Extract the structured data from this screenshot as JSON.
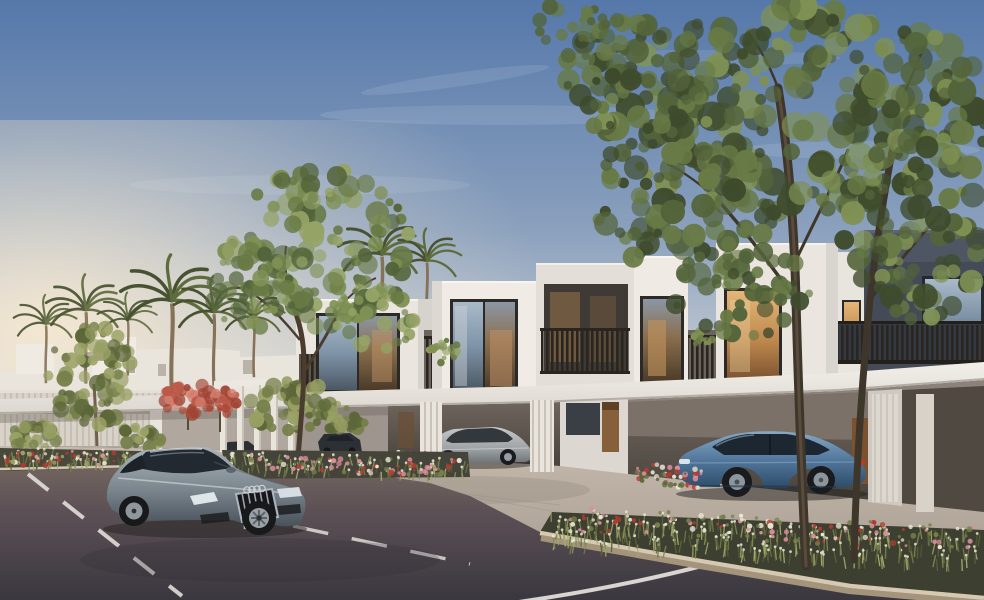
{
  "meta": {
    "description": "Architectural rendering of a modern townhouse community at dusk: white cubic two-storey townhouses with carports, a grey coupe driving on the road, a silver sedan and a blue fastback parked under carports, palm trees, large green trees and flower planters.",
    "width": 984,
    "height": 600,
    "visible_text": ""
  },
  "palette": {
    "skyTop": "#5578aa",
    "skyMid": "#8aa0bd",
    "skyLow": "#c6cdd4",
    "skyWarm": "#efe7dd",
    "glow": "#f7e9d2",
    "cloud": "#ffffff",
    "white1": "#f0ece5",
    "white2": "#e2ded8",
    "white3": "#d3cfc9",
    "parapet": "#c1bcb5",
    "darkFac": "#4e5663",
    "darkFac2": "#3c434f",
    "frame": "#2c2a28",
    "glassTop": "#a9bac9",
    "glassMid": "#7f94a8",
    "glassBot": "#4c5864",
    "warmHi": "#e4b678",
    "warm": "#c08a4e",
    "warmLo": "#7d5430",
    "rail": "#2b251f",
    "railBase": "#5d554a",
    "railBaseDark": "#343a44",
    "fascia1": "#f2efe9",
    "fascia2": "#dcd7d0",
    "soffit": "#6e675e",
    "wall1": "#b2a9a0",
    "wall2": "#9a928a",
    "wall3": "#867e76",
    "open1": "#6e655d",
    "open2": "#49433d",
    "door": "#86603a",
    "doorDark": "#5f4226",
    "fence1": "#d8d2c8",
    "fence2": "#c6bfb4",
    "pillar1": "#e9e4dc",
    "pillar2": "#c9c2b8",
    "pave1": "#c4b9ac",
    "pave2": "#a89d91",
    "pave3": "#93897e",
    "road1": "#746760",
    "road2": "#5d5156",
    "road3": "#3a373f",
    "mark": "#eae6e0",
    "curb1": "#d6c9b1",
    "curb2": "#a3947b",
    "soil": "#49483a",
    "soilDark": "#36362c",
    "grassGreen": "#7c8850",
    "grassLight": "#a3ab6e",
    "leafDark": "#3e4b2c",
    "leaf": "#53643a",
    "leafMid": "#687a45",
    "leafLight": "#7f9154",
    "leafPale": "#95a366",
    "bushDark": "#5c6638",
    "bush": "#76804a",
    "bushLight": "#98a064",
    "redTreeD": "#a04334",
    "redTree": "#bc5847",
    "redTreeL": "#d47b6b",
    "flowerWhite": "#ece7d6",
    "flowerPink": "#dc8f9c",
    "flowerRed": "#b23b33",
    "trunk": "#4a3c2e",
    "trunkLight": "#71604b",
    "palmGreen": "#5e6b3c",
    "palmDark": "#475230",
    "palmTrunk": "#857258",
    "carbody1": "#aab4ba",
    "carbody2": "#79848c",
    "carbody3": "#49525a",
    "carGlass": "#222930",
    "carChrome": "#c2c9cf",
    "blue1": "#86a9c4",
    "blue2": "#53789d",
    "blue3": "#2d4c67",
    "silver1": "#c6c7c8",
    "silver2": "#9fa3a6",
    "silver3": "#6e7377",
    "tyre": "#191b1e",
    "rim": "#969da3",
    "shadow": "#23211f",
    "plate": "#e2e2de",
    "taillight": "#c0392b"
  },
  "vehicles": [
    {
      "name": "grey-coupe-driving",
      "color": "#79848c",
      "position": "foreground road, facing right"
    },
    {
      "name": "silver-sedan-parked",
      "color": "#c6c7c8",
      "position": "middle carport"
    },
    {
      "name": "blue-fastback-parked",
      "color": "#53789d",
      "position": "right carport"
    },
    {
      "name": "distant-dark-car",
      "color": "#2c3034",
      "position": "far left driveway"
    }
  ],
  "vegetation": [
    {
      "target": "tree-right-foliage",
      "type": "leaves",
      "cx": 800,
      "cy": 108,
      "rx": 200,
      "ry": 105,
      "count": 250,
      "rmin": 5,
      "rmax": 15,
      "colors": [
        "leafDark",
        "leaf",
        "leafMid",
        "leafLight"
      ],
      "seed": 7
    },
    {
      "target": "tree-right-foliage",
      "type": "leaves",
      "cx": 688,
      "cy": 198,
      "rx": 95,
      "ry": 78,
      "count": 95,
      "rmin": 4,
      "rmax": 13,
      "colors": [
        "leafDark",
        "leaf",
        "leafMid"
      ],
      "seed": 21
    },
    {
      "target": "tree-right-foliage",
      "type": "leaves",
      "cx": 915,
      "cy": 225,
      "rx": 72,
      "ry": 95,
      "count": 90,
      "rmin": 4,
      "rmax": 13,
      "colors": [
        "leafDark",
        "leaf",
        "leafMid",
        "leafLight"
      ],
      "seed": 33
    },
    {
      "target": "tree-right-foliage",
      "type": "leaves",
      "cx": 742,
      "cy": 292,
      "rx": 70,
      "ry": 46,
      "count": 46,
      "rmin": 3,
      "rmax": 10,
      "colors": [
        "leaf",
        "leafMid",
        "leafDark"
      ],
      "seed": 44
    },
    {
      "target": "tree-right-foliage",
      "type": "leaves",
      "cx": 636,
      "cy": 76,
      "rx": 72,
      "ry": 62,
      "count": 60,
      "rmin": 4,
      "rmax": 12,
      "colors": [
        "leafDark",
        "leaf",
        "leafMid"
      ],
      "seed": 55
    },
    {
      "target": "tree-right-foliage",
      "type": "leaves",
      "cx": 596,
      "cy": 26,
      "rx": 58,
      "ry": 34,
      "count": 30,
      "rmin": 3,
      "rmax": 9,
      "colors": [
        "leaf",
        "leafMid"
      ],
      "seed": 66
    },
    {
      "target": "veg-mid-tree",
      "type": "leaves",
      "cx": 318,
      "cy": 248,
      "rx": 96,
      "ry": 80,
      "count": 130,
      "rmin": 4,
      "rmax": 12,
      "colors": [
        "leaf",
        "leafMid",
        "leafLight",
        "leafPale"
      ],
      "seed": 9
    },
    {
      "target": "veg-mid-tree",
      "type": "leaves",
      "cx": 252,
      "cy": 292,
      "rx": 46,
      "ry": 40,
      "count": 40,
      "rmin": 3,
      "rmax": 9,
      "colors": [
        "leafMid",
        "leafLight",
        "leaf"
      ],
      "seed": 19
    },
    {
      "target": "veg-mid-tree",
      "type": "leaves",
      "cx": 372,
      "cy": 318,
      "rx": 44,
      "ry": 34,
      "count": 34,
      "rmin": 3,
      "rmax": 8,
      "colors": [
        "leafMid",
        "leafLight",
        "leafPale"
      ],
      "seed": 29
    },
    {
      "target": "veg-left-tree",
      "type": "leaves",
      "cx": 92,
      "cy": 376,
      "rx": 44,
      "ry": 50,
      "count": 76,
      "rmin": 3,
      "rmax": 9,
      "colors": [
        "bushDark",
        "bush",
        "bushLight"
      ],
      "seed": 13
    },
    {
      "target": "veg-left-bushes",
      "type": "leaves",
      "cx": 32,
      "cy": 436,
      "rx": 28,
      "ry": 13,
      "count": 30,
      "rmin": 3,
      "rmax": 7,
      "colors": [
        "bushDark",
        "bush",
        "bushLight"
      ],
      "seed": 14
    },
    {
      "target": "veg-left-bushes",
      "type": "leaves",
      "cx": 142,
      "cy": 436,
      "rx": 25,
      "ry": 12,
      "count": 26,
      "rmin": 3,
      "rmax": 7,
      "colors": [
        "bushDark",
        "bush",
        "bushLight"
      ],
      "seed": 15
    },
    {
      "target": "veg-mid-bushes",
      "type": "leaves",
      "cx": 292,
      "cy": 406,
      "rx": 44,
      "ry": 27,
      "count": 48,
      "rmin": 3,
      "rmax": 9,
      "colors": [
        "bushDark",
        "bush",
        "bushLight"
      ],
      "seed": 16
    },
    {
      "target": "veg-mid-bushes",
      "type": "leaves",
      "cx": 344,
      "cy": 416,
      "rx": 26,
      "ry": 17,
      "count": 26,
      "rmin": 3,
      "rmax": 7,
      "colors": [
        "bushDark",
        "bush",
        "bushLight"
      ],
      "seed": 17
    },
    {
      "target": "veg-red-trees",
      "type": "leaves",
      "cx": 188,
      "cy": 397,
      "rx": 27,
      "ry": 19,
      "count": 34,
      "rmin": 3,
      "rmax": 7,
      "colors": [
        "redTreeD",
        "redTree",
        "redTreeL"
      ],
      "seed": 18
    },
    {
      "target": "veg-red-trees",
      "type": "leaves",
      "cx": 220,
      "cy": 403,
      "rx": 20,
      "ry": 14,
      "count": 24,
      "rmin": 2,
      "rmax": 6,
      "colors": [
        "redTreeD",
        "redTree",
        "redTreeL"
      ],
      "seed": 28
    },
    {
      "target": "veg-balcony",
      "type": "leaves",
      "cx": 444,
      "cy": 352,
      "rx": 16,
      "ry": 12,
      "count": 18,
      "rmin": 2,
      "rmax": 5,
      "colors": [
        "leafMid",
        "leafLight",
        "leafPale"
      ],
      "seed": 31
    },
    {
      "target": "veg-balcony",
      "type": "leaves",
      "cx": 702,
      "cy": 340,
      "rx": 11,
      "ry": 9,
      "count": 12,
      "rmin": 2,
      "rmax": 4,
      "colors": [
        "leafMid",
        "leafLight"
      ],
      "seed": 32
    },
    {
      "target": "bed-left",
      "type": "grass",
      "x0": 6,
      "x1": 184,
      "ybase": 448,
      "slope": 0.02,
      "h": 14,
      "count": 90,
      "len": 9,
      "colors": [
        "grassGreen",
        "grassLight",
        "bushDark"
      ],
      "tip": "flowerWhite",
      "tipChance": 0.35,
      "seed": 41
    },
    {
      "target": "bed-left",
      "type": "flowers",
      "x0": 6,
      "x1": 184,
      "ybase": 450,
      "slope": 0.02,
      "h": 15,
      "count": 70,
      "rmin": 1.2,
      "rmax": 2.6,
      "colors": [
        "flowerPink",
        "flowerRed",
        "flowerWhite",
        "bushLight"
      ],
      "seed": 42
    },
    {
      "target": "bed-mid",
      "type": "grass",
      "x0": 224,
      "x1": 466,
      "ybase": 452,
      "slope": 0.03,
      "h": 16,
      "count": 110,
      "len": 9,
      "colors": [
        "grassGreen",
        "grassLight",
        "bushDark"
      ],
      "tip": "flowerWhite",
      "tipChance": 0.4,
      "seed": 43
    },
    {
      "target": "bed-mid",
      "type": "flowers",
      "x0": 224,
      "x1": 466,
      "ybase": 452,
      "slope": 0.03,
      "h": 18,
      "count": 90,
      "rmin": 1.2,
      "rmax": 2.8,
      "colors": [
        "flowerRed",
        "flowerWhite",
        "flowerPink",
        "bush"
      ],
      "seed": 45
    },
    {
      "target": "bed-carport",
      "type": "flowers",
      "x0": 378,
      "x1": 462,
      "ybase": 451,
      "slope": 0.02,
      "h": 10,
      "count": 44,
      "rmin": 1.2,
      "rmax": 2.6,
      "colors": [
        "flowerRed",
        "flowerRed",
        "bushDark",
        "flowerWhite"
      ],
      "seed": 46
    },
    {
      "target": "bed-right-inner",
      "type": "flowers",
      "x0": 636,
      "x1": 702,
      "ybase": 462,
      "slope": 0.12,
      "h": 20,
      "count": 56,
      "rmin": 1.3,
      "rmax": 3,
      "colors": [
        "flowerRed",
        "flowerPink",
        "bushDark",
        "flowerWhite"
      ],
      "seed": 47
    },
    {
      "target": "planter-grass",
      "type": "grass",
      "x0": 548,
      "x1": 980,
      "ybase": 508,
      "slope": 0.05,
      "h": 34,
      "count": 300,
      "len": 12,
      "colors": [
        "grassGreen",
        "grassLight",
        "bushDark"
      ],
      "tip": "flowerWhite",
      "tipChance": 0.5,
      "seed": 48
    },
    {
      "target": "planter-flowers",
      "type": "flowers",
      "x0": 560,
      "x1": 978,
      "ybase": 506,
      "slope": 0.05,
      "h": 26,
      "count": 130,
      "rmin": 1.3,
      "rmax": 3,
      "colors": [
        "flowerRed",
        "flowerWhite",
        "flowerPink",
        "bush"
      ],
      "seed": 49
    }
  ],
  "road": {
    "marking_color": "#eae6e0",
    "markings": [
      "left dashed lane line",
      "center dashed lane line",
      "solid edge line lower right"
    ]
  }
}
